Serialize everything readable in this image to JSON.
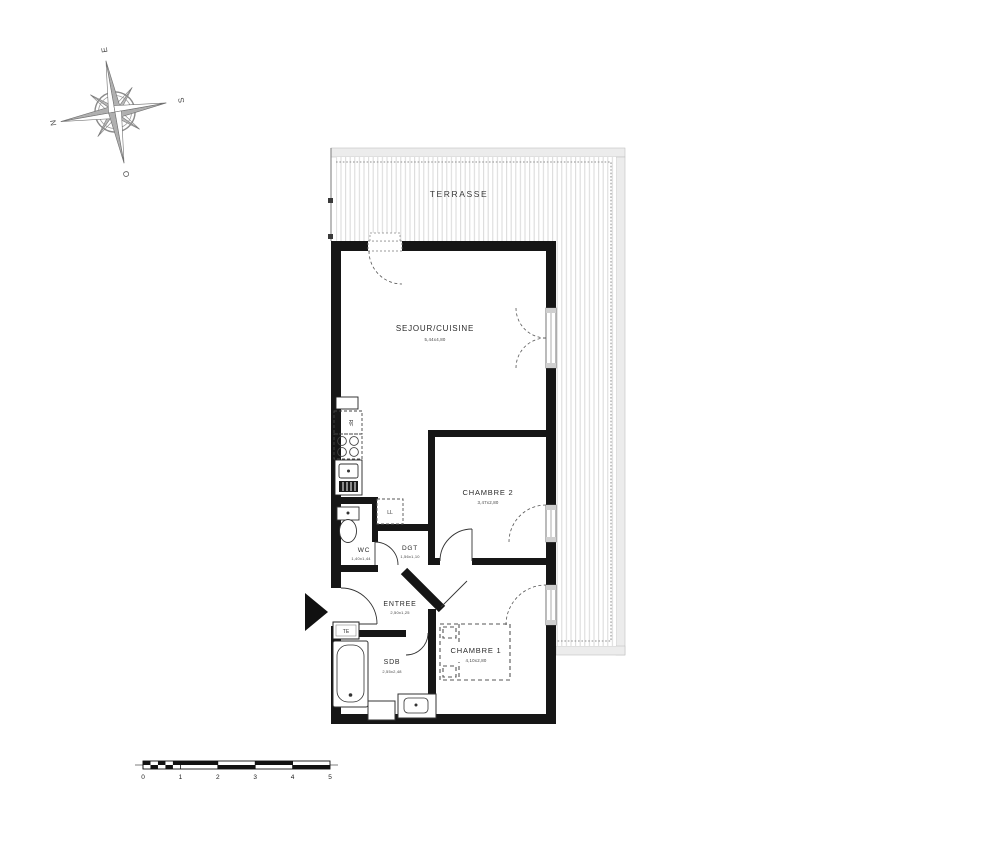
{
  "compass": {
    "n": "N",
    "e": "E",
    "s": "S",
    "o": "O"
  },
  "terrace": {
    "label": "TERRASSE"
  },
  "rooms": {
    "sejour": {
      "label": "SEJOUR/CUISINE",
      "dims": "5,44x4,80"
    },
    "chambre2": {
      "label": "CHAMBRE 2",
      "dims": "3,47x2,80"
    },
    "wc": {
      "label": "WC",
      "dims": "1,40x1,44"
    },
    "dgt": {
      "label": "DGT",
      "dims": "1,56x1,10"
    },
    "entree": {
      "label": "ENTREE",
      "dims": "2,50x1,25"
    },
    "sdb": {
      "label": "SDB",
      "dims": "2,55x2,48"
    },
    "chambre1": {
      "label": "CHAMBRE 1",
      "dims": "4,10x2,80"
    }
  },
  "fixtures": {
    "fridge": "RF",
    "washing_machine": "LL",
    "electrical_panel": "TE"
  },
  "scale_bar": {
    "labels": [
      "0",
      "1",
      "2",
      "3",
      "4",
      "5"
    ]
  },
  "colors": {
    "wall": "#161616",
    "deck_line": "#d9d9d9",
    "railing": "#ececec",
    "dash": "#555555",
    "thin_line": "#333333"
  }
}
